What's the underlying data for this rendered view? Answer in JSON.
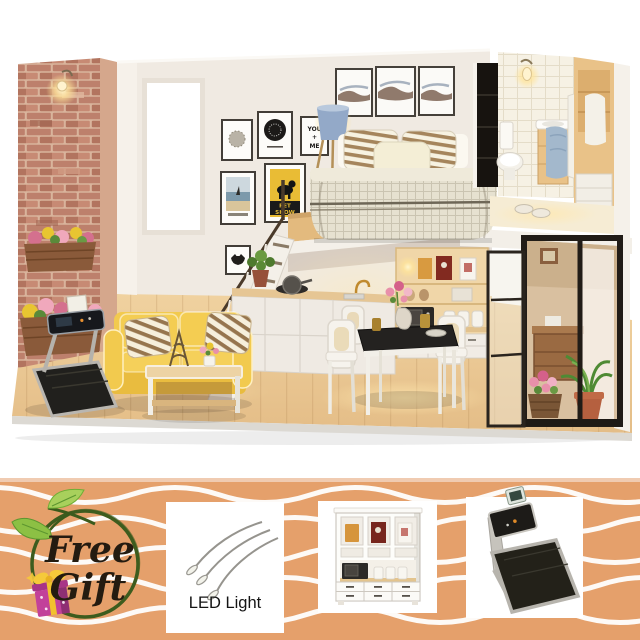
{
  "product": {
    "description": "DIY miniature dollhouse loft diorama photo with free gift promo banner"
  },
  "photo": {
    "posters": {
      "you_me": [
        "YOU",
        "+",
        "ME"
      ],
      "pet_show": [
        "PET",
        "SHOW"
      ]
    },
    "palette": {
      "floor_wood": "#ecca94",
      "brick": "#bd806c",
      "wall": "#f0eae2",
      "sofa_yellow": "#f2ca4e",
      "loft_wood": "#e3ba7e",
      "glass_frame": "#211c17",
      "warm_light": "#ffd98a"
    }
  },
  "banner": {
    "background": "#e5a06b",
    "top_strip": "#f0cbb1",
    "wave_color": "#ffffff",
    "badge": {
      "line1": "Free",
      "line2": "Gift",
      "text_color": "#241b10",
      "circle_color": "#3d5c1e",
      "leaf_icon_color": "#8cc044",
      "gift_icon_color": "#c2419a",
      "ribbon_color": "#f2c12e"
    },
    "panels": [
      {
        "name": "led-light-gift",
        "label": "LED Light"
      },
      {
        "name": "miniature-cabinet-gift",
        "label": ""
      },
      {
        "name": "miniature-treadmill-gift",
        "label": ""
      }
    ]
  }
}
